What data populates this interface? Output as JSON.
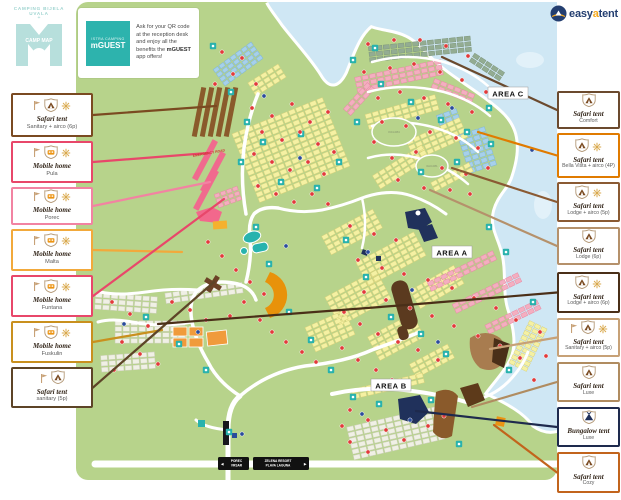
{
  "brand": {
    "title": "CAMPING BIJELA UVALA",
    "plus": "+",
    "map_label": "CAMP MAP",
    "color": "#b7dfdb"
  },
  "mguest": {
    "brand_small": "ISTRA CAMPING",
    "brand": "mGUEST",
    "text_pre": "Ask for your QR code at the reception desk and enjoy all the benefits the ",
    "brand_inline": "mGUEST",
    "text_post": " app offers!",
    "accent": "#2db3ad"
  },
  "easyatent": {
    "easy": "easy",
    "a": "a",
    "tent": "tent",
    "navy": "#233e70",
    "orange": "#f5a81c"
  },
  "legend_left": [
    {
      "type": "Safari tent",
      "name": "Sanitary + airco (6p)",
      "color": "#7a4a21",
      "icons": [
        "flag",
        "shield-tent",
        "sun"
      ],
      "line_to": [
        216,
        106
      ]
    },
    {
      "type": "Mobile home",
      "name": "Pula",
      "color": "#e8476a",
      "icons": [
        "flag",
        "shield-home",
        "sun"
      ],
      "line_to": [
        208,
        153
      ]
    },
    {
      "type": "Mobile home",
      "name": "Porec",
      "color": "#f283a2",
      "icons": [
        "flag",
        "shield-home",
        "sun"
      ],
      "line_to": [
        210,
        182
      ]
    },
    {
      "type": "Mobile home",
      "name": "Malta",
      "color": "#f2a93b",
      "icons": [
        "flag",
        "shield-home",
        "sun"
      ],
      "line_to": [
        182,
        252
      ]
    },
    {
      "type": "Mobile home",
      "name": "Funtana",
      "color": "#e8476a",
      "icons": [
        "flag",
        "shield-home",
        "sun"
      ],
      "line_to": [
        224,
        199
      ]
    },
    {
      "type": "Mobile home",
      "name": "Fuskulin",
      "color": "#c9901e",
      "icons": [
        "flag",
        "shield-home",
        "sun"
      ],
      "line_to": [
        162,
        330
      ]
    },
    {
      "type": "Safari tent",
      "name": "sanitary (5p)",
      "color": "#5d4427",
      "icons": [
        "flag",
        "shield-tent"
      ],
      "line_to": [
        214,
        282
      ]
    }
  ],
  "legend_right": [
    {
      "type": "Safari tent",
      "name": "Comfort",
      "color": "#6b4a2e",
      "icons": [
        "shield-tent"
      ],
      "line_to": [
        442,
        57
      ]
    },
    {
      "type": "Safari tent",
      "name": "Bella Vista + airco (4P)",
      "color": "#e07b00",
      "icons": [
        "shield-tent",
        "sun"
      ],
      "line_to": [
        478,
        132
      ]
    },
    {
      "type": "Safari tent",
      "name": "Lodge + airco (5p)",
      "color": "#8a5a33",
      "icons": [
        "shield-tent",
        "sun"
      ],
      "line_to": [
        452,
        168
      ]
    },
    {
      "type": "Safari tent",
      "name": "Lodge (6p)",
      "color": "#b5916b",
      "icons": [
        "shield-tent"
      ],
      "line_to": [
        430,
        190
      ]
    },
    {
      "type": "Safari tent",
      "name": "Lodge + airco (6p)",
      "color": "#4a2f18",
      "icons": [
        "shield-tent",
        "sun"
      ],
      "line_via": [
        406,
        305
      ],
      "line_to": [
        158,
        324
      ]
    },
    {
      "type": "Safari tent",
      "name": "Sanitary + airco (5p)",
      "color": "#c7a177",
      "icons": [
        "flag",
        "shield-tent",
        "sun"
      ],
      "line_to": [
        490,
        349
      ]
    },
    {
      "type": "Safari tent",
      "name": "Luxe",
      "color": "#b08c60",
      "icons": [
        "shield-tent"
      ],
      "line_to": [
        472,
        407
      ]
    },
    {
      "type": "Bungalow tent",
      "name": "Luxe",
      "color": "#1e2a4d",
      "icons": [
        "shield-bungalow"
      ],
      "line_to": [
        416,
        411
      ]
    },
    {
      "type": "Safari tent",
      "name": "Cozy",
      "color": "#c2641c",
      "icons": [
        "shield-tent"
      ],
      "line_to": [
        494,
        425
      ]
    }
  ],
  "map": {
    "area_labels": [
      {
        "text": "AREA A",
        "x": 452,
        "y": 253
      },
      {
        "text": "AREA B",
        "x": 391,
        "y": 386
      },
      {
        "text": "AREA C",
        "x": 508,
        "y": 94
      }
    ],
    "signs": {
      "left": [
        "POREC",
        "VRSAR"
      ],
      "right": [
        "ZELENA RESORT",
        "PLAVA LAGUNA"
      ],
      "left_arrow": "◄",
      "right_arrow": "►"
    },
    "emergency_label": "EMERGENCY ROAD",
    "plot_labels": [
      {
        "text": "K04-084",
        "x": 394,
        "y": 133
      },
      {
        "text": "0A3-081",
        "x": 432,
        "y": 167
      }
    ],
    "colors": {
      "land": "#b7d38b",
      "sea": "#cfe7f4",
      "beach": "#ffffff",
      "road": "#ffffff",
      "yellow": "#f5f1a3",
      "yellow_s": "#d9d27b",
      "pink": "#f4aec0",
      "pink_s": "#e78ba4",
      "blue": "#a6d0eb",
      "blue_s": "#7fb6da",
      "sage": "#93ac92",
      "sage_s": "#7e977d",
      "grey": "#f0f0e5",
      "grey_s": "#d0d0c0",
      "teal": "#29b2ad",
      "red_dot": "#e23a3a",
      "blue_dot": "#2a4b9b",
      "brown": "#8a5a2b",
      "dark_brown": "#5d3a1f",
      "tan": "#a87c4f",
      "navy": "#20315b",
      "orange": "#ec9413"
    },
    "clusters": [
      [
        238,
        64,
        -36,
        4,
        7,
        5.5,
        4,
        "B"
      ],
      [
        477,
        150,
        -18,
        7,
        4,
        6,
        4.5,
        "B"
      ],
      [
        448,
        117,
        -20,
        2,
        3,
        6,
        4.5,
        "B"
      ],
      [
        420,
        49,
        -6,
        3,
        14,
        6,
        4.2,
        "S"
      ],
      [
        487,
        67,
        33,
        2,
        5,
        6,
        4.2,
        "S"
      ],
      [
        399,
        76,
        -12,
        3,
        12,
        6,
        4.2,
        "P"
      ],
      [
        359,
        99,
        -48,
        2,
        5,
        6,
        4.2,
        "P"
      ],
      [
        453,
        91,
        22,
        2,
        6,
        6,
        4.2,
        "P"
      ],
      [
        402,
        112,
        -16,
        3,
        10,
        6,
        4.2,
        "Y"
      ],
      [
        437,
        139,
        -24,
        4,
        8,
        6,
        4.2,
        "Y"
      ],
      [
        401,
        167,
        -32,
        3,
        8,
        6,
        4.2,
        "Y"
      ],
      [
        452,
        177,
        -28,
        2,
        6,
        6,
        4.2,
        "Y"
      ],
      [
        291,
        150,
        -22,
        13,
        13,
        6.2,
        4.4,
        "Y"
      ],
      [
        267,
        80,
        -32,
        3,
        5,
        6,
        4.2,
        "Y"
      ],
      [
        352,
        232,
        -28,
        4,
        8,
        6,
        4.2,
        "Y"
      ],
      [
        391,
        259,
        -28,
        5,
        9,
        6,
        4.2,
        "Y"
      ],
      [
        437,
        287,
        -30,
        4,
        7,
        6,
        4.2,
        "Y"
      ],
      [
        358,
        298,
        -28,
        6,
        8,
        6,
        4.2,
        "Y"
      ],
      [
        330,
        331,
        -24,
        5,
        6,
        6,
        4.2,
        "Y"
      ],
      [
        396,
        337,
        -28,
        5,
        7,
        6,
        4.2,
        "Y"
      ],
      [
        432,
        361,
        -28,
        3,
        6,
        6,
        4.2,
        "Y"
      ],
      [
        528,
        346,
        26,
        9,
        3,
        5.5,
        4,
        "Y"
      ],
      [
        388,
        386,
        -13,
        2,
        10,
        6,
        4.2,
        "Y"
      ],
      [
        462,
        271,
        -26,
        2,
        10,
        6,
        4.2,
        "P"
      ],
      [
        487,
        293,
        -26,
        2,
        10,
        6,
        4.2,
        "P"
      ],
      [
        513,
        317,
        -26,
        2,
        8,
        6,
        4.2,
        "P"
      ],
      [
        228,
        197,
        -20,
        3,
        4,
        5,
        3.8,
        "P"
      ],
      [
        126,
        303,
        4,
        3,
        8,
        6.5,
        4.5,
        "G"
      ],
      [
        150,
        332,
        0,
        4,
        9,
        6.5,
        4.5,
        "G"
      ],
      [
        128,
        362,
        -4,
        3,
        7,
        6.5,
        4.5,
        "G"
      ],
      [
        204,
        293,
        -8,
        2,
        10,
        6.5,
        4.5,
        "G"
      ],
      [
        396,
        433,
        -13,
        6,
        12,
        6.5,
        4.4,
        "G"
      ]
    ],
    "dots_red": [
      [
        222,
        52
      ],
      [
        242,
        58
      ],
      [
        233,
        74
      ],
      [
        256,
        84
      ],
      [
        215,
        84
      ],
      [
        252,
        108
      ],
      [
        272,
        116
      ],
      [
        292,
        104
      ],
      [
        310,
        122
      ],
      [
        328,
        112
      ],
      [
        262,
        132
      ],
      [
        282,
        140
      ],
      [
        300,
        132
      ],
      [
        318,
        144
      ],
      [
        334,
        152
      ],
      [
        254,
        154
      ],
      [
        272,
        162
      ],
      [
        290,
        170
      ],
      [
        308,
        162
      ],
      [
        324,
        174
      ],
      [
        258,
        186
      ],
      [
        276,
        194
      ],
      [
        294,
        202
      ],
      [
        312,
        194
      ],
      [
        328,
        204
      ],
      [
        368,
        44
      ],
      [
        394,
        40
      ],
      [
        420,
        40
      ],
      [
        446,
        46
      ],
      [
        468,
        56
      ],
      [
        364,
        72
      ],
      [
        390,
        68
      ],
      [
        414,
        64
      ],
      [
        440,
        72
      ],
      [
        462,
        80
      ],
      [
        486,
        92
      ],
      [
        378,
        98
      ],
      [
        400,
        92
      ],
      [
        424,
        98
      ],
      [
        448,
        104
      ],
      [
        472,
        112
      ],
      [
        382,
        122
      ],
      [
        406,
        126
      ],
      [
        430,
        132
      ],
      [
        456,
        138
      ],
      [
        478,
        148
      ],
      [
        374,
        142
      ],
      [
        392,
        158
      ],
      [
        416,
        152
      ],
      [
        442,
        168
      ],
      [
        466,
        174
      ],
      [
        488,
        168
      ],
      [
        398,
        180
      ],
      [
        424,
        188
      ],
      [
        450,
        190
      ],
      [
        470,
        194
      ],
      [
        350,
        226
      ],
      [
        374,
        234
      ],
      [
        396,
        240
      ],
      [
        358,
        260
      ],
      [
        382,
        268
      ],
      [
        404,
        274
      ],
      [
        428,
        280
      ],
      [
        452,
        288
      ],
      [
        474,
        298
      ],
      [
        496,
        308
      ],
      [
        516,
        320
      ],
      [
        364,
        292
      ],
      [
        386,
        300
      ],
      [
        410,
        308
      ],
      [
        432,
        316
      ],
      [
        454,
        326
      ],
      [
        478,
        336
      ],
      [
        500,
        346
      ],
      [
        520,
        358
      ],
      [
        344,
        312
      ],
      [
        360,
        324
      ],
      [
        378,
        334
      ],
      [
        398,
        342
      ],
      [
        418,
        350
      ],
      [
        438,
        360
      ],
      [
        342,
        348
      ],
      [
        358,
        360
      ],
      [
        376,
        370
      ],
      [
        392,
        380
      ],
      [
        112,
        302
      ],
      [
        130,
        314
      ],
      [
        148,
        326
      ],
      [
        122,
        342
      ],
      [
        140,
        354
      ],
      [
        158,
        364
      ],
      [
        114,
        370
      ],
      [
        172,
        302
      ],
      [
        190,
        310
      ],
      [
        206,
        320
      ],
      [
        208,
        242
      ],
      [
        222,
        256
      ],
      [
        236,
        270
      ],
      [
        250,
        282
      ],
      [
        264,
        294
      ],
      [
        244,
        302
      ],
      [
        230,
        316
      ],
      [
        260,
        320
      ],
      [
        272,
        332
      ],
      [
        286,
        342
      ],
      [
        302,
        352
      ],
      [
        316,
        362
      ],
      [
        350,
        410
      ],
      [
        368,
        420
      ],
      [
        386,
        430
      ],
      [
        404,
        440
      ],
      [
        350,
        442
      ],
      [
        368,
        452
      ],
      [
        342,
        426
      ],
      [
        428,
        426
      ],
      [
        444,
        416
      ],
      [
        540,
        332
      ],
      [
        546,
        356
      ],
      [
        534,
        380
      ]
    ],
    "dots_blue": [
      [
        264,
        96
      ],
      [
        300,
        158
      ],
      [
        418,
        118
      ],
      [
        452,
        108
      ],
      [
        368,
        252
      ],
      [
        412,
        290
      ],
      [
        438,
        342
      ],
      [
        124,
        324
      ],
      [
        198,
        332
      ],
      [
        362,
        414
      ],
      [
        410,
        420
      ],
      [
        532,
        150
      ],
      [
        242,
        434
      ],
      [
        286,
        246
      ]
    ],
    "facilities": [
      [
        213,
        46
      ],
      [
        231,
        92
      ],
      [
        247,
        122
      ],
      [
        263,
        142
      ],
      [
        241,
        162
      ],
      [
        281,
        182
      ],
      [
        317,
        188
      ],
      [
        339,
        162
      ],
      [
        301,
        134
      ],
      [
        353,
        60
      ],
      [
        381,
        84
      ],
      [
        411,
        102
      ],
      [
        441,
        120
      ],
      [
        467,
        132
      ],
      [
        491,
        144
      ],
      [
        457,
        162
      ],
      [
        421,
        172
      ],
      [
        357,
        122
      ],
      [
        346,
        240
      ],
      [
        366,
        277
      ],
      [
        391,
        317
      ],
      [
        421,
        334
      ],
      [
        446,
        354
      ],
      [
        256,
        227
      ],
      [
        269,
        264
      ],
      [
        289,
        312
      ],
      [
        311,
        340
      ],
      [
        331,
        370
      ],
      [
        146,
        317
      ],
      [
        179,
        344
      ],
      [
        206,
        370
      ],
      [
        229,
        432
      ],
      [
        353,
        397
      ],
      [
        379,
        404
      ],
      [
        431,
        400
      ],
      [
        459,
        444
      ],
      [
        509,
        370
      ],
      [
        533,
        302
      ],
      [
        506,
        252
      ],
      [
        489,
        227
      ],
      [
        375,
        48
      ],
      [
        489,
        108
      ]
    ]
  }
}
